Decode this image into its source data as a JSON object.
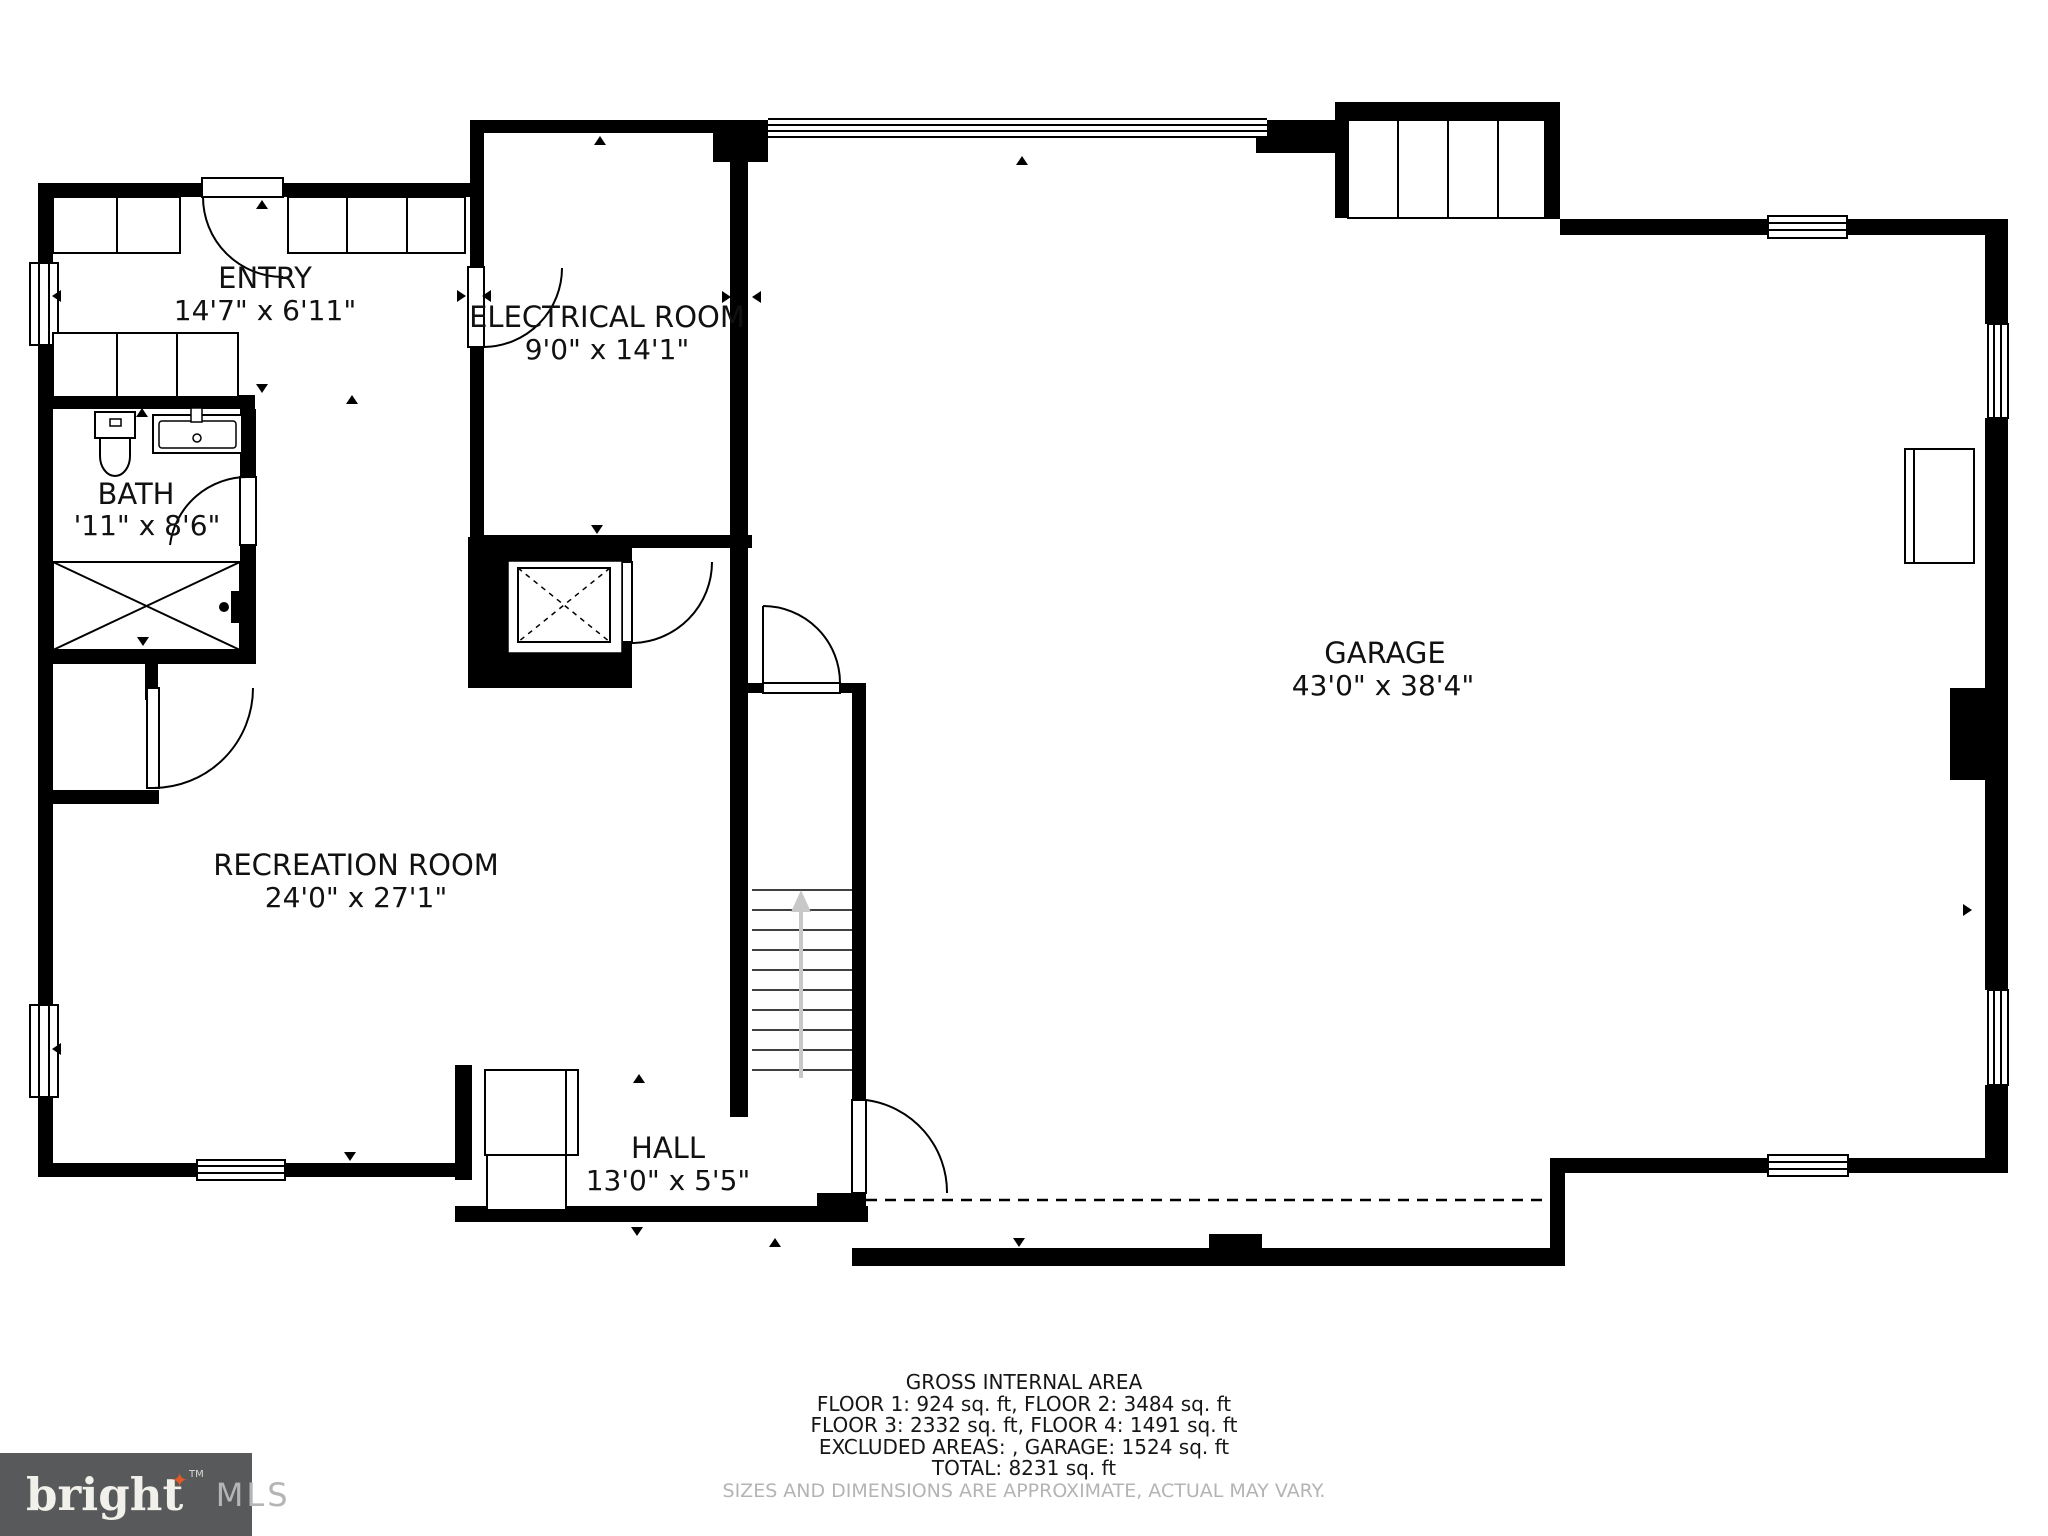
{
  "rooms": {
    "entry": {
      "name": "ENTRY",
      "dims": "14'7\" x 6'11\""
    },
    "electrical": {
      "name": "ELECTRICAL ROOM",
      "dims": "9'0\" x 14'1\""
    },
    "bath": {
      "name": "BATH",
      "dims": "'11\" x 8'6\""
    },
    "garage": {
      "name": "GARAGE",
      "dims": "43'0\" x 38'4\""
    },
    "recreation": {
      "name": "RECREATION ROOM",
      "dims": "24'0\" x 27'1\""
    },
    "hall": {
      "name": "HALL",
      "dims": "13'0\" x 5'5\""
    }
  },
  "footer": {
    "line1": "GROSS INTERNAL AREA",
    "line2": "FLOOR 1: 924 sq. ft, FLOOR 2: 3484 sq. ft",
    "line3": "FLOOR 3: 2332 sq. ft, FLOOR 4: 1491 sq. ft",
    "line4": "EXCLUDED AREAS: , GARAGE: 1524 sq. ft",
    "line5": "TOTAL: 8231 sq. ft",
    "disclaimer": "SIZES AND DIMENSIONS ARE APPROXIMATE, ACTUAL MAY VARY."
  },
  "logo": {
    "brand": "bright",
    "tm": "TM",
    "suffix": "MLS",
    "colors": {
      "background": "#58595b",
      "brand_text": "#f2f0ea",
      "star": "#e25a28",
      "suffix_text": "#b4b5b7"
    }
  },
  "colors": {
    "walls": "#000000",
    "background": "#ffffff",
    "stair_arrow": "#c8c8c8",
    "label_text": "#111111",
    "disclaimer_text": "#b4b4b4"
  }
}
